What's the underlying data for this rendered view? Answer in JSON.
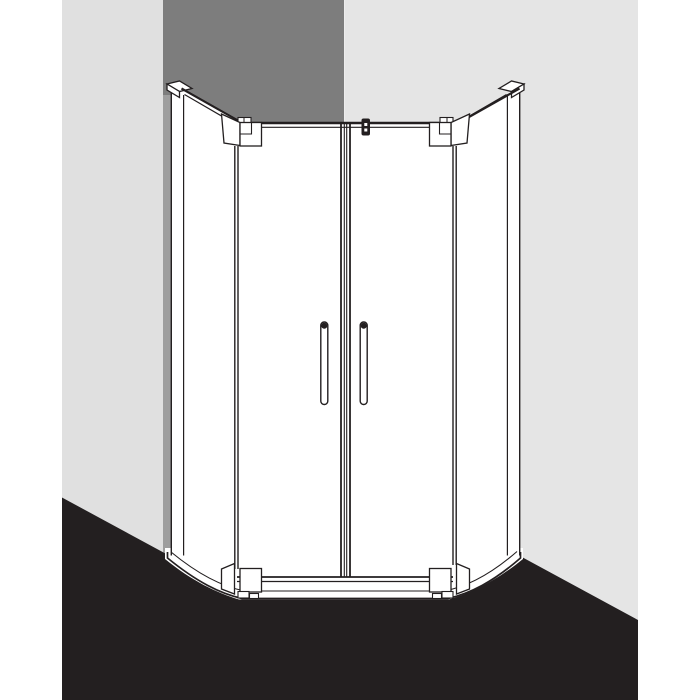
{
  "scene": {
    "description": "Line-art technical illustration of a pentagonal corner-entry shower enclosure with two hinged doors, shown in a room corner with shadowed wall and dark floor",
    "colors": {
      "background": "#ffffff",
      "wall_left": "#e0e0e0",
      "wall_right": "#e5e5e5",
      "wall_corner_shadow": "#7d7d7d",
      "corner_highlight": "#ededed",
      "profile_shadow_face": "#9e9e9e",
      "floor": "#231f20",
      "outline": "#231f20",
      "glass": "#ffffff"
    },
    "elements": [
      "left wall",
      "corner wall in shadow",
      "right wall",
      "dark floor",
      "white shower tray with rounded front corners",
      "left wall profile with cap",
      "right wall profile with cap",
      "angled left side panel",
      "angled right side panel",
      "left hinged door",
      "right hinged door",
      "two vertical bar handles",
      "four corner hinge blocks",
      "glass clamp at top centre"
    ]
  }
}
